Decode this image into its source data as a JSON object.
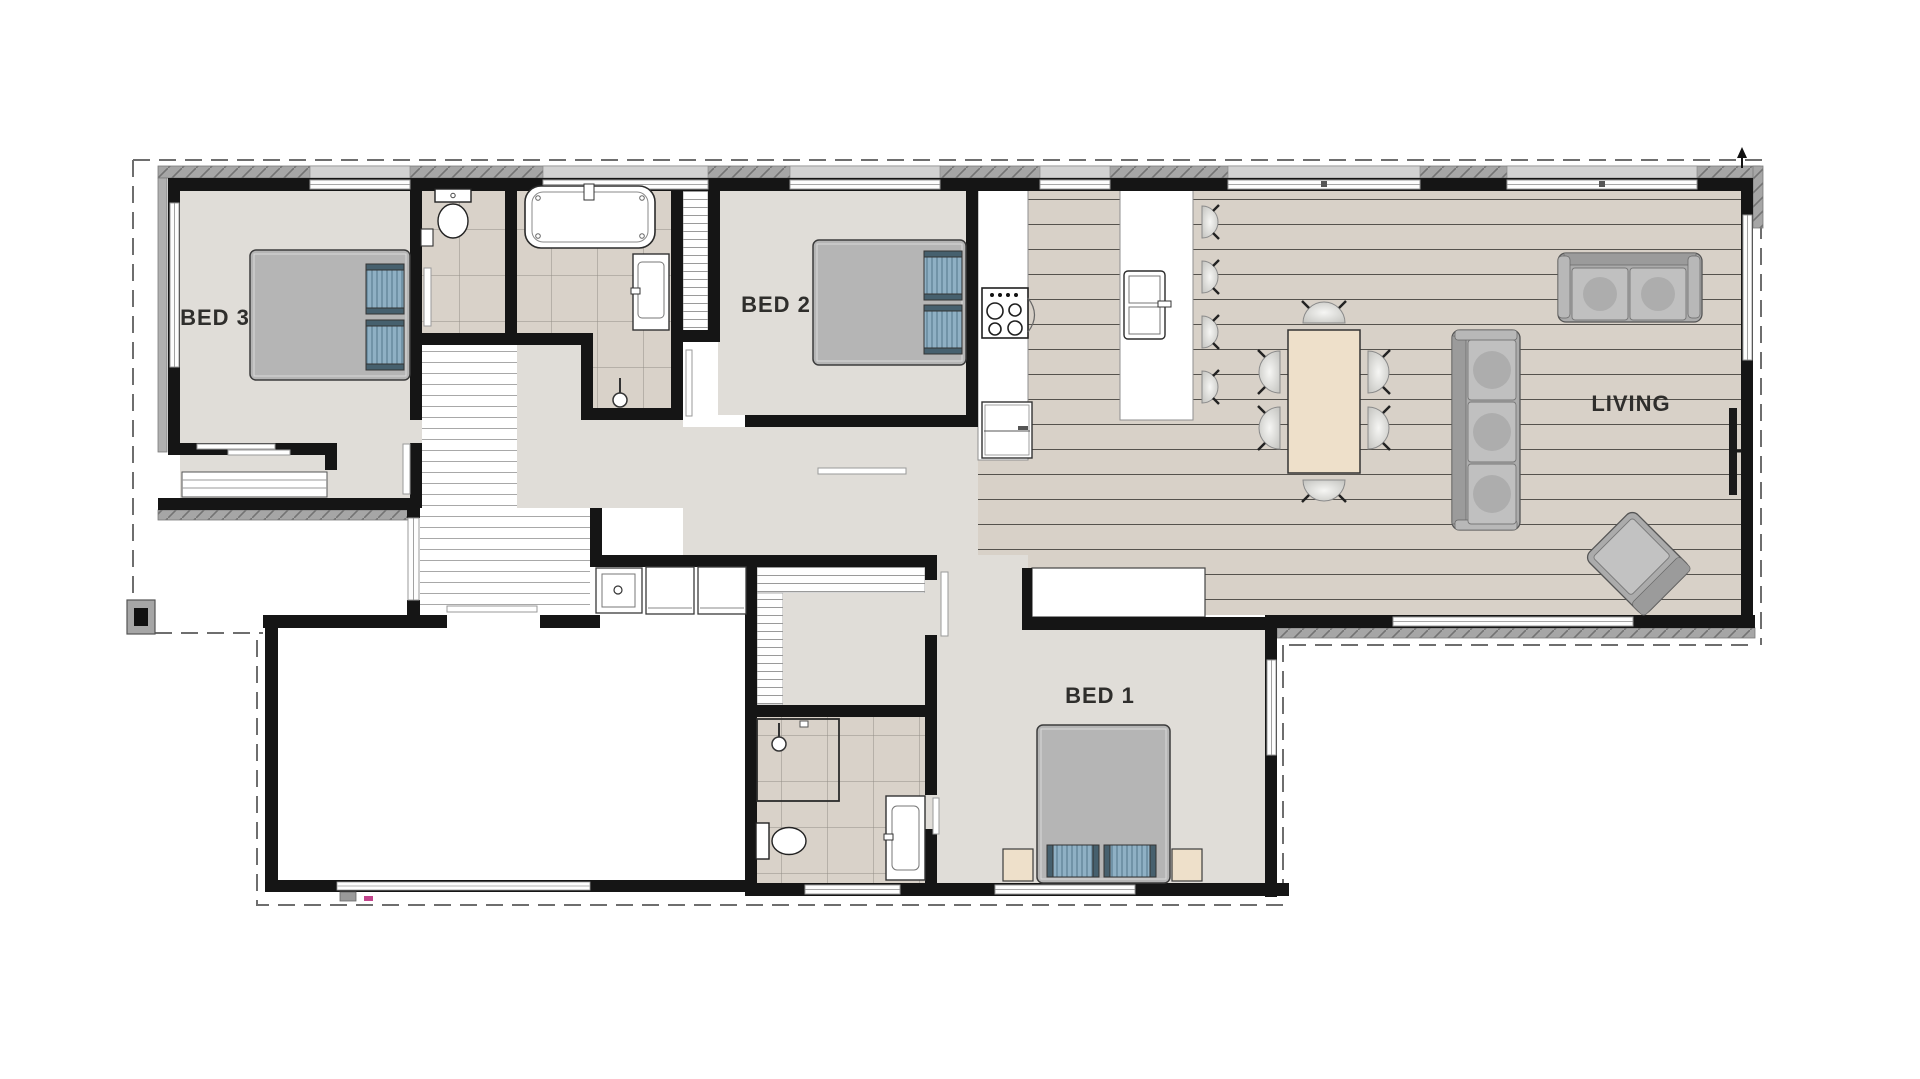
{
  "page": {
    "type": "architectural-floor-plan",
    "background": "#ffffff"
  },
  "labels": {
    "bed3": "BED 3",
    "bed2": "BED 2",
    "bed1": "BED 1",
    "living": "LIVING"
  },
  "rooms": [
    {
      "label": "BED 3"
    },
    {
      "label": "BED 2"
    },
    {
      "label": "BED 1"
    },
    {
      "label": "LIVING"
    }
  ],
  "fixtures": [
    "double-bed",
    "pillows",
    "sliding-wardrobe",
    "walk-in-robe-shelves",
    "linen-shelves",
    "toilet",
    "hand-basin",
    "bathtub",
    "vanity-basin",
    "shower",
    "shower-head",
    "cooktop",
    "rangehood",
    "fridge",
    "island-bench",
    "island-sink",
    "bar-stool",
    "dining-table",
    "dining-chair",
    "sofa-3-seat",
    "sofa-2-seat",
    "armchair",
    "tv",
    "laundry-tub",
    "washing-machine",
    "dryer",
    "porch-post",
    "downpipe",
    "garage-door",
    "front-door",
    "north-arrow"
  ],
  "colors": {
    "wall": "#151515",
    "floor_gray": "#e0ddd8",
    "floor_tile": "#d9d2c9",
    "floor_wood": "#d8d1c8",
    "floor_hall_planks": "#ffffff",
    "eave_band": "#a6a6a6",
    "dining_table": "#eee0ca",
    "bed": "#b5b5b5",
    "pillow": "#8fb0c4",
    "sofa": "#ababab",
    "chair": "#e9e9e6",
    "label_text": "#2f2e2c"
  }
}
